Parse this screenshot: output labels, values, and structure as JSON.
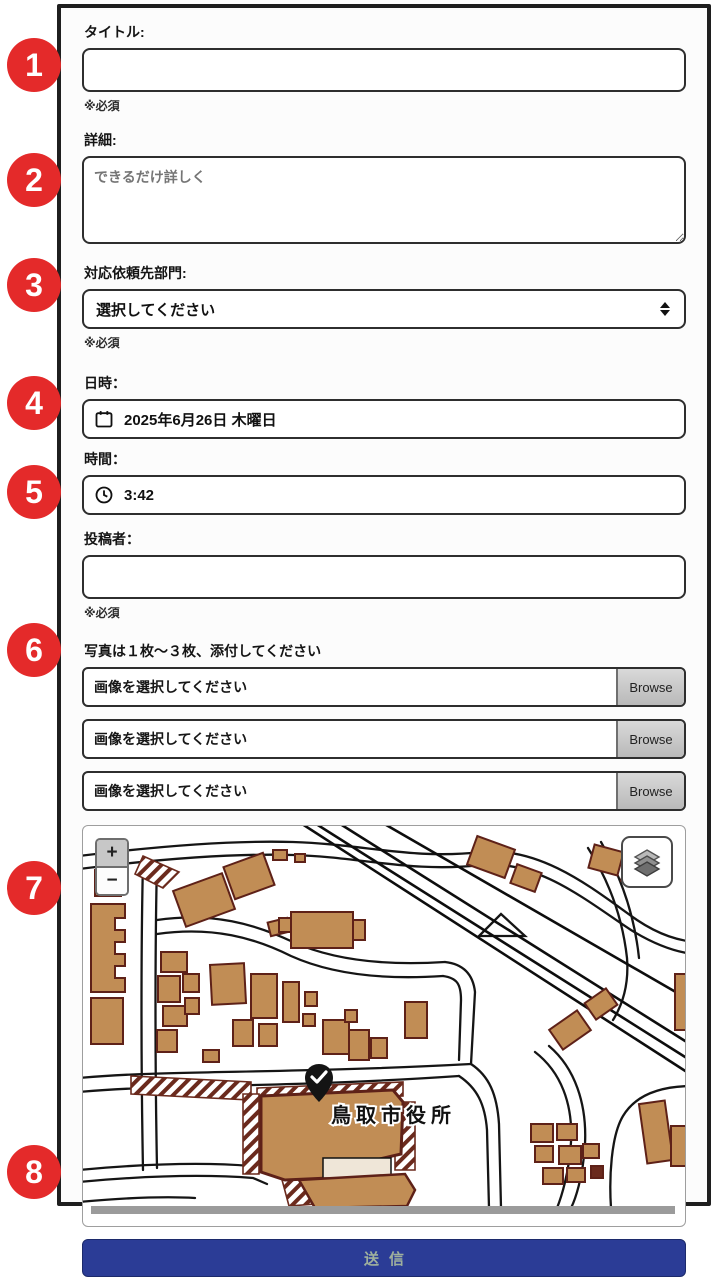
{
  "annotations": {
    "color": "#e42a2a",
    "items": [
      {
        "number": "1"
      },
      {
        "number": "2"
      },
      {
        "number": "3"
      },
      {
        "number": "4"
      },
      {
        "number": "5"
      },
      {
        "number": "6"
      },
      {
        "number": "7"
      },
      {
        "number": "8"
      }
    ]
  },
  "form": {
    "title": {
      "label": "タイトル:",
      "value": "",
      "required_note": "※必須"
    },
    "details": {
      "label": "詳細:",
      "placeholder": "できるだけ詳しく"
    },
    "department": {
      "label": "対応依頼先部門:",
      "selected_option": "選択してください",
      "required_note": "※必須"
    },
    "date": {
      "label": "日時：",
      "value": "2025年6月26日 木曜日"
    },
    "time": {
      "label": "時間：",
      "value": "3:42"
    },
    "author": {
      "label": "投稿者：",
      "value": "",
      "required_note": "※必須"
    },
    "photos": {
      "label": "写真は１枚〜３枚、添付してください",
      "placeholder": "画像を選択してください",
      "browse_label": "Browse"
    },
    "submit": {
      "label": "送信",
      "color": "#2b3c96"
    }
  },
  "map": {
    "place_label": "鳥取市役所",
    "zoom_in_label": "+",
    "zoom_out_label": "−",
    "colors": {
      "building_fill": "#c18d55",
      "building_outline": "#5e2118",
      "road": "#151515",
      "scrollbar": "#9b9b9b"
    }
  }
}
